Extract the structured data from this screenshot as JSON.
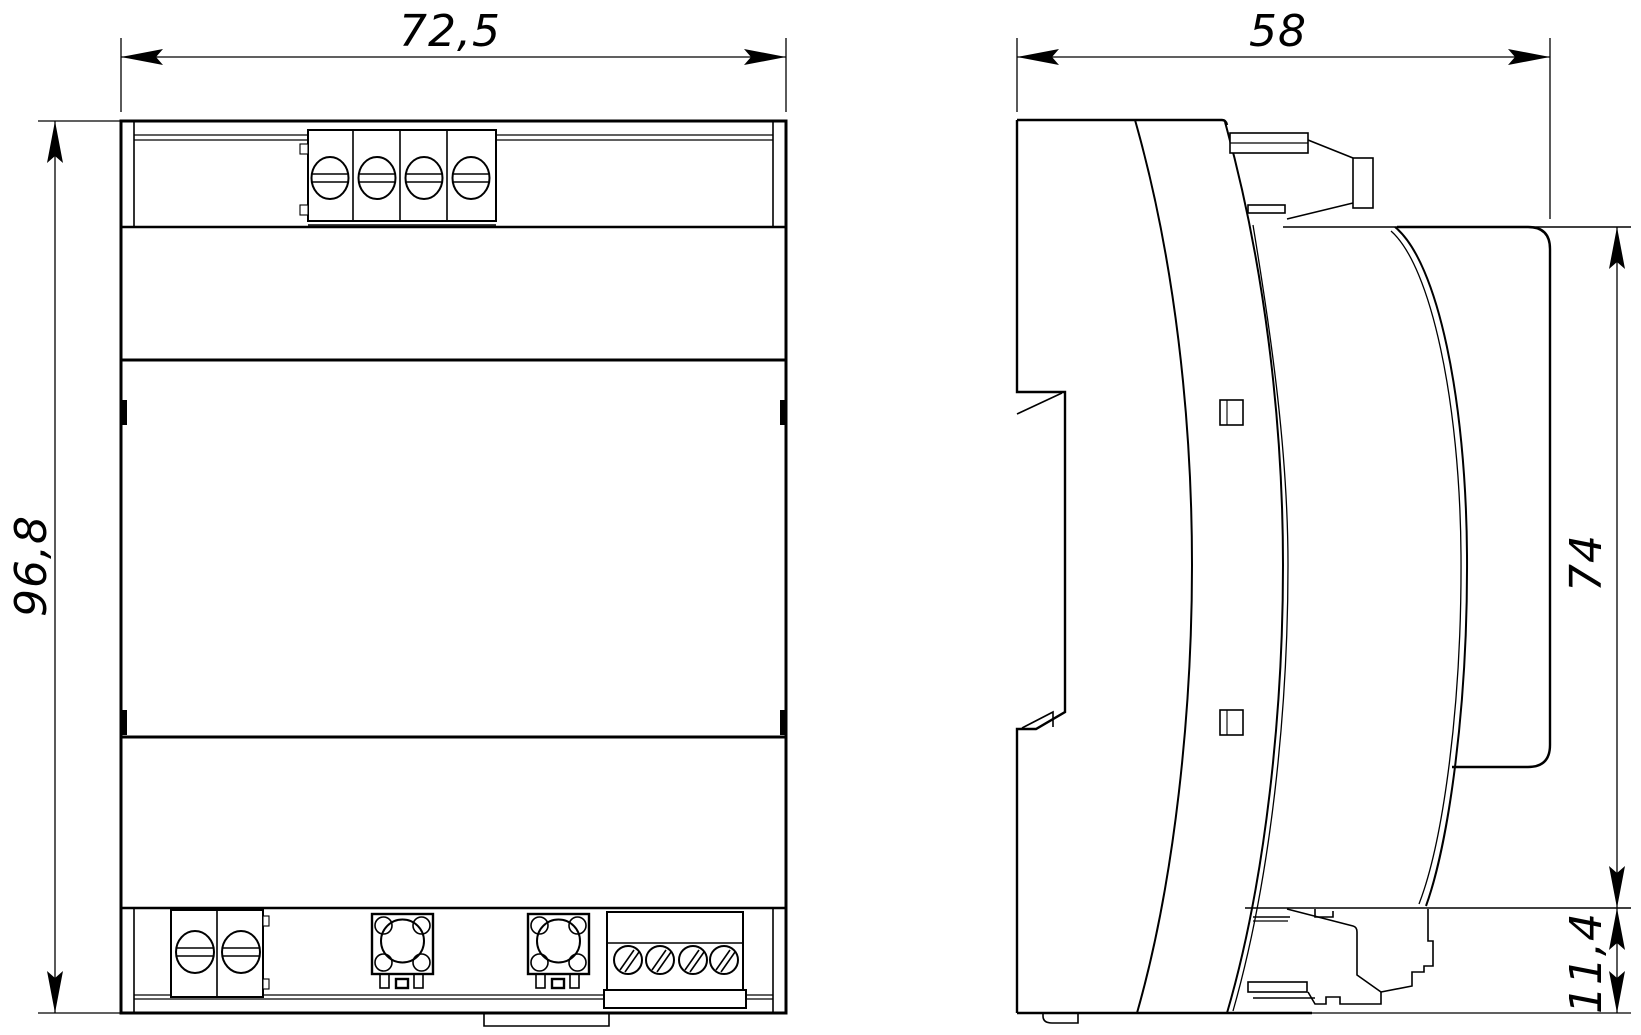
{
  "drawing": {
    "type": "engineering-dimension-drawing",
    "views": [
      {
        "id": "front-view",
        "label": "front view of DIN-rail module"
      },
      {
        "id": "side-view",
        "label": "side view of DIN-rail module"
      }
    ],
    "dimensions": {
      "overall_width": "72,5",
      "overall_height": "96,8",
      "overall_depth": "58",
      "front_panel_height": "74",
      "rail_clip_height": "11,4"
    },
    "colors": {
      "line": "#000000",
      "background": "#ffffff"
    }
  }
}
